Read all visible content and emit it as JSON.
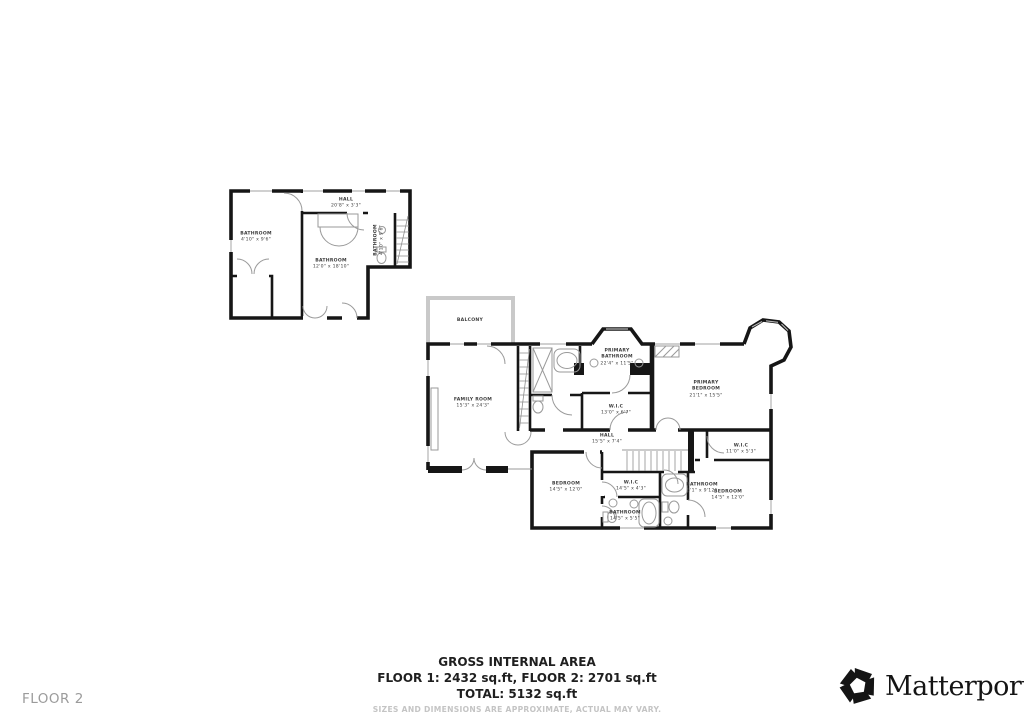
{
  "footer": {
    "floor_label": "FLOOR 2",
    "gross_title": "GROSS INTERNAL AREA",
    "floors_line": "FLOOR 1: 2432 sq.ft, FLOOR 2: 2701 sq.ft",
    "total_line": "TOTAL: 5132 sq.ft",
    "disclaimer": "SIZES AND DIMENSIONS ARE APPROXIMATE, ACTUAL MAY VARY.",
    "brand_name": "Matterport",
    "brand_mark": "®"
  },
  "colors": {
    "wall": "#161616",
    "fixture": "#9a9a9a",
    "balcony_outline": "#c9c9c9",
    "label_text": "#3d3d3d",
    "muted_text": "#9b9b9b",
    "disclaimer_text": "#c4c4c4"
  },
  "icons": {
    "brand_logo": "matterport-pinwheel-icon"
  },
  "rooms": [
    {
      "name": "BATHROOM",
      "dims": "4'10\" x 9'6\""
    },
    {
      "name": "HALL",
      "dims": "20'8\" x 3'3\""
    },
    {
      "name": "BATHROOM",
      "dims": "12'0\" x 18'10\""
    },
    {
      "name": "BATHROOM",
      "dims": "4'10\" x 9'6\""
    },
    {
      "name": "BALCONY",
      "dims": ""
    },
    {
      "name": "FAMILY ROOM",
      "dims": "15'3\" x 24'3\""
    },
    {
      "name": "PRIMARY BATHROOM",
      "dims": "22'4\" x 11'5\""
    },
    {
      "name": "PRIMARY BEDROOM",
      "dims": "21'1\" x 15'5\""
    },
    {
      "name": "W.I.C",
      "dims": "13'0\" x 6'7\""
    },
    {
      "name": "HALL",
      "dims": "15'5\" x 7'4\""
    },
    {
      "name": "W.I.C",
      "dims": "11'0\" x 5'3\""
    },
    {
      "name": "BEDROOM",
      "dims": "14'5\" x 12'0\""
    },
    {
      "name": "W.I.C",
      "dims": "14'5\" x 4'3\""
    },
    {
      "name": "BATHROOM",
      "dims": "5'1\" x 9'12\""
    },
    {
      "name": "BEDROOM",
      "dims": "14'5\" x 12'0\""
    },
    {
      "name": "BATHROOM",
      "dims": "14'5\" x 5'5\""
    }
  ]
}
